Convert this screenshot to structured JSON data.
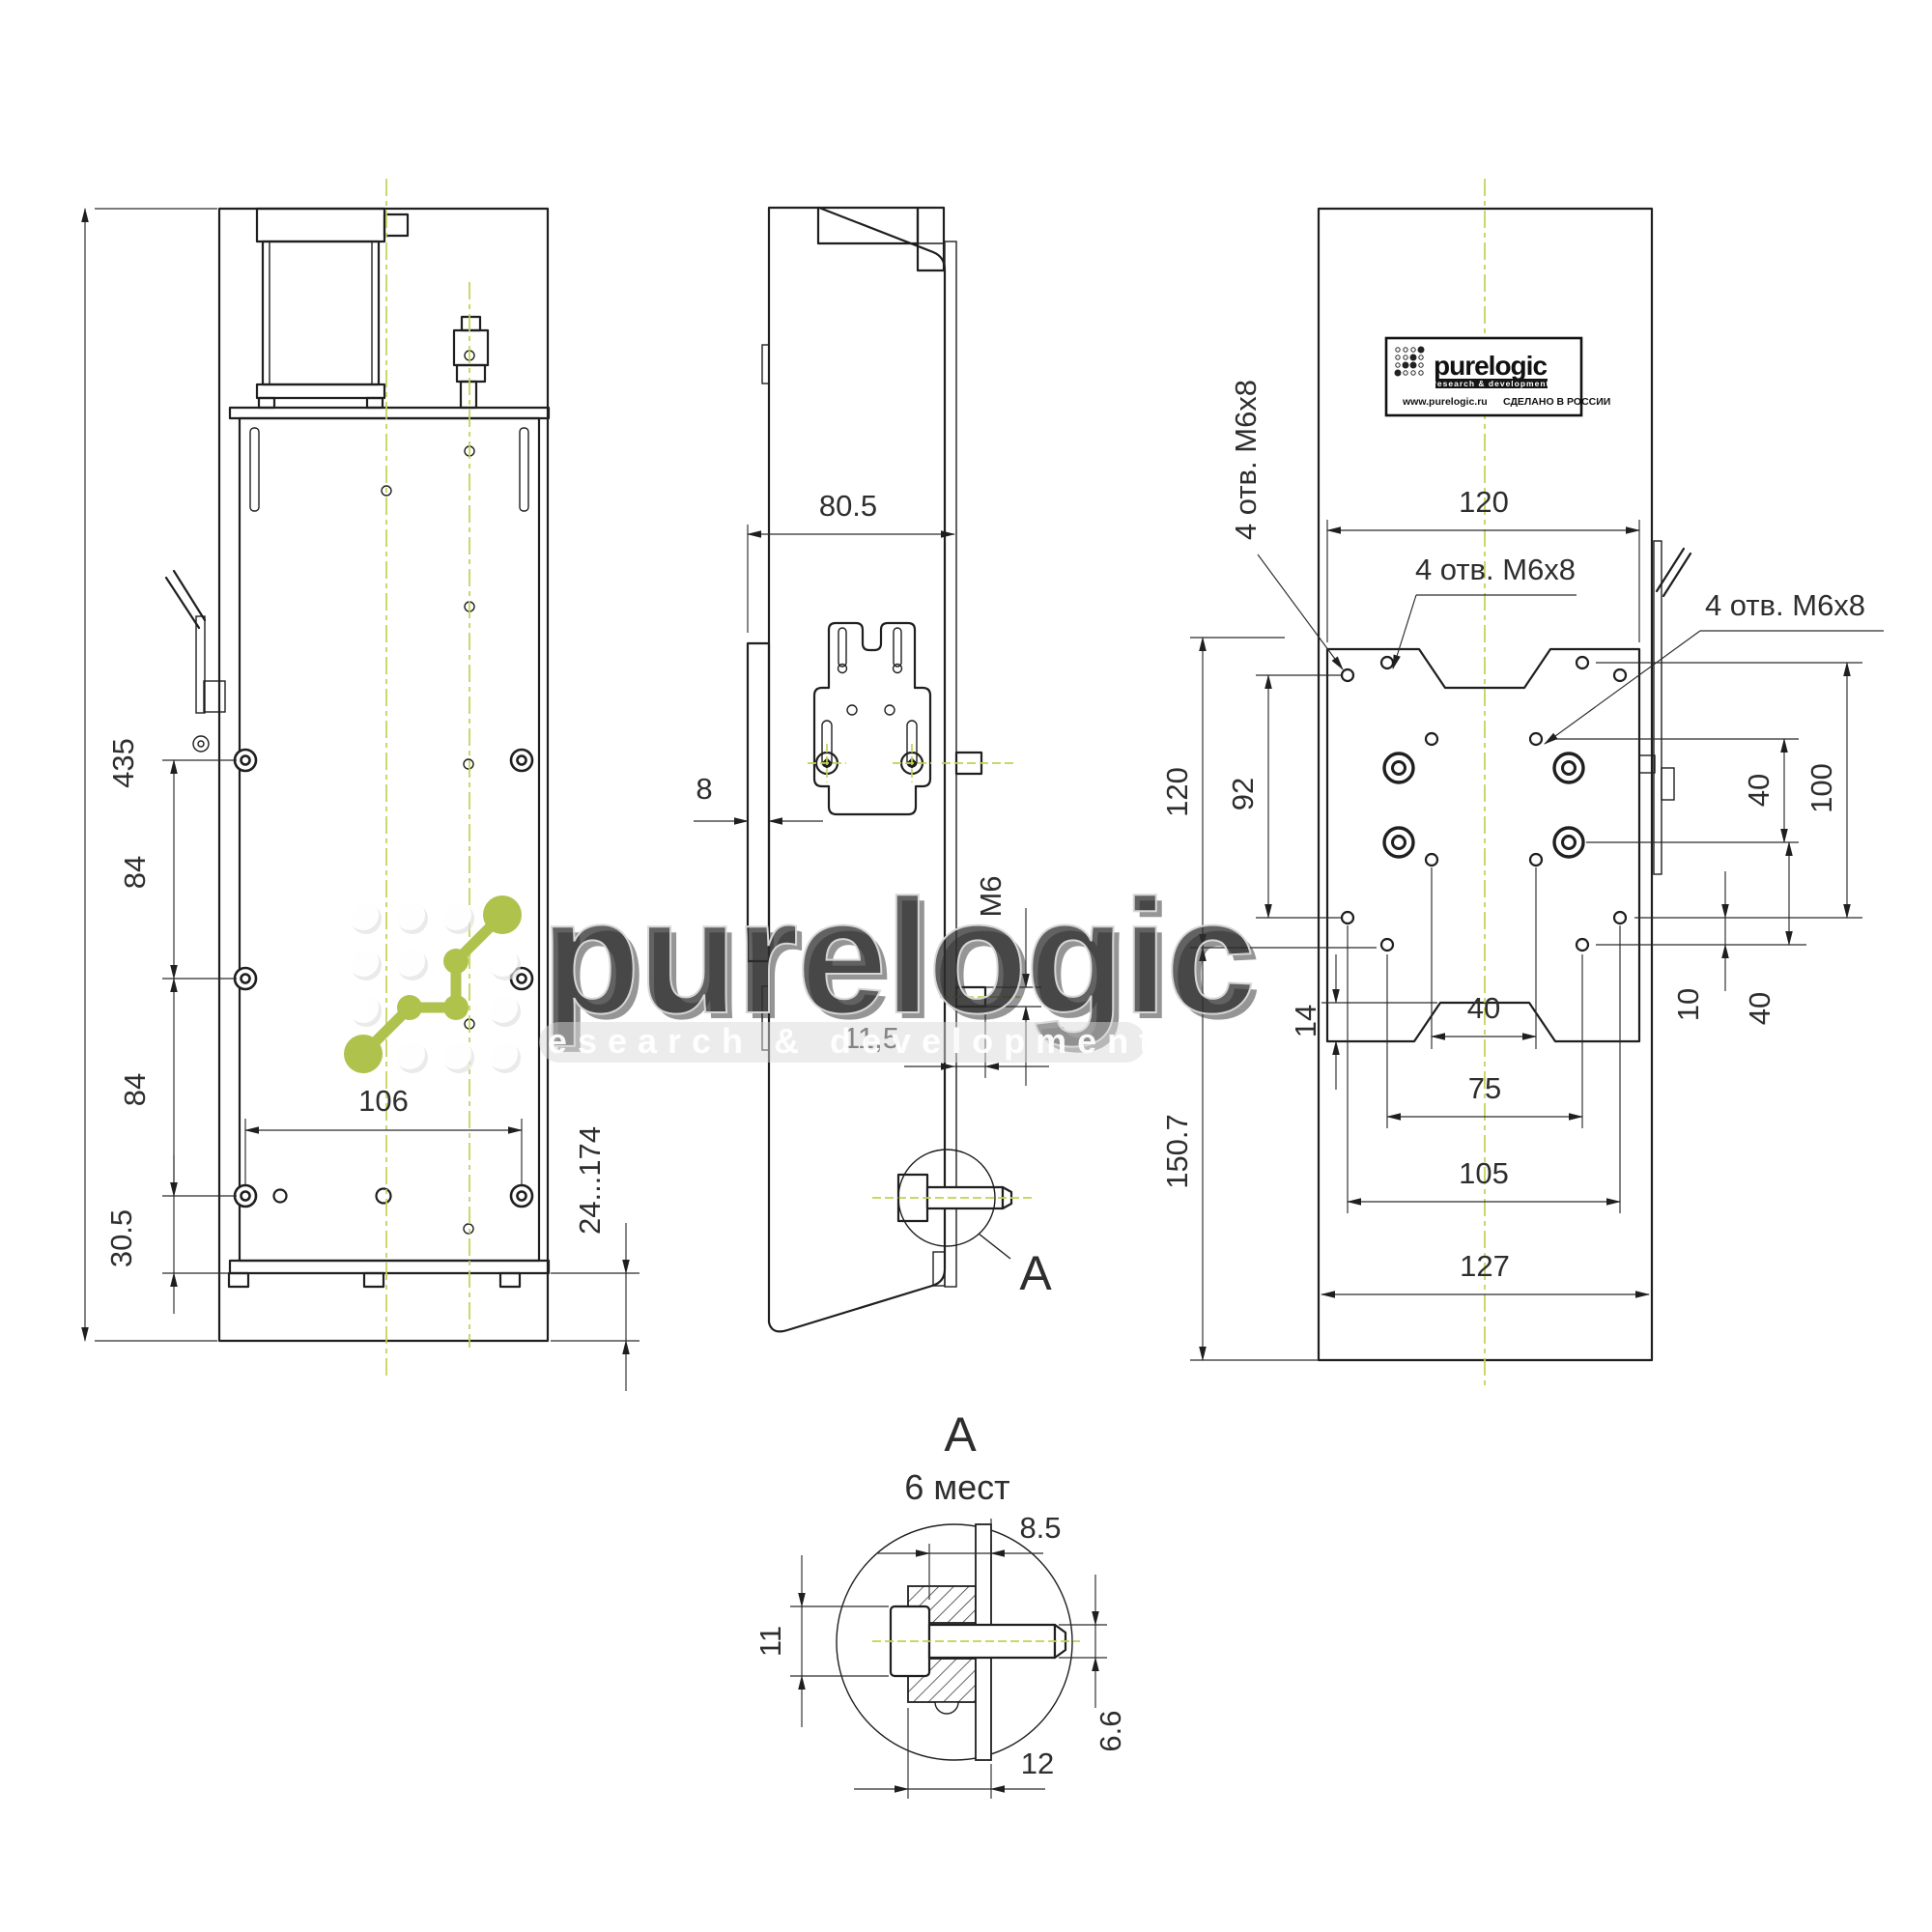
{
  "front": {
    "height": "435",
    "pitch_a": "84",
    "pitch_b": "84",
    "bottom_offset": "30.5",
    "hole_span": "106",
    "travel": "24...174"
  },
  "side": {
    "depth": "80.5",
    "plate_thickness": "8",
    "pin_thread": "M6",
    "pin_offset": "11,5",
    "detail_ref": "A"
  },
  "rear": {
    "plate_width": "120",
    "hole_note": "4 отв. M6x8",
    "col_span": "92",
    "notch": "14",
    "upper_height": "120",
    "lower_height": "150.7",
    "right_step": "40",
    "right_span": "100",
    "bottom_step": "10",
    "bottom_span": "40",
    "center_span": "40",
    "span_75": "75",
    "span_105": "105",
    "body_width": "127"
  },
  "detail": {
    "title": "A",
    "places": "6 мест",
    "grip": "8.5",
    "head": "11",
    "hole_dia": "6.6",
    "total": "12"
  },
  "plate": {
    "brand": "purelogic",
    "tagline": "research & development",
    "url": "www.purelogic.ru",
    "origin": "СДЕЛАНО В РОССИИ"
  },
  "watermark": {
    "brand": "purelogic",
    "tagline": "research & development"
  }
}
